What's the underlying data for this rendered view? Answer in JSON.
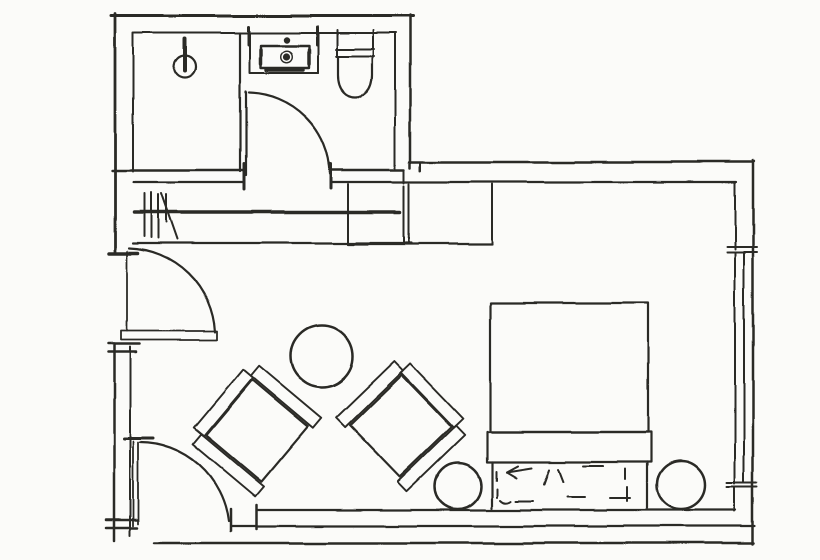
{
  "canvas": {
    "width": 820,
    "height": 560,
    "background": "#fbfbf9",
    "ink": "#2b2a26"
  },
  "floorplan": {
    "description": "hand-drawn floor plan sketch of a hotel room with bathroom, closet, seating area and bed",
    "elements": [
      {
        "name": "top-wall-outer",
        "d": "M111,16 H413",
        "w": 3
      },
      {
        "name": "top-wall-inner",
        "d": "M134,33 H396",
        "w": 2
      },
      {
        "name": "left-wall-upper-outer",
        "d": "M115,14 V252",
        "w": 2.8
      },
      {
        "name": "bathroom-left-wall-inner",
        "d": "M133,33 V171",
        "w": 2
      },
      {
        "name": "left-wall-door-jamb-tick",
        "d": "M109,253 H138",
        "w": 3.5
      },
      {
        "name": "left-wall-lower-outer",
        "d": "M114,344 V541",
        "w": 2.5
      },
      {
        "name": "left-wall-lower-inner",
        "d": "M130,347 V536",
        "w": 2
      },
      {
        "name": "left-wall-cap-ticks",
        "d": "M108,344 H140 M108,352 H136 M106,520 H137 M106,528 H137",
        "w": 2.5
      },
      {
        "name": "bathroom-right-wall-outer",
        "d": "M410,15 V168",
        "w": 2.5
      },
      {
        "name": "bathroom-right-wall-inner",
        "d": "M395,33 V170",
        "w": 2
      },
      {
        "name": "bathroom-south-wall-outer",
        "d": "M112,170 H244 M331,170 H404",
        "w": 2.4
      },
      {
        "name": "main-inner-wall-line",
        "d": "M133,182 H244 M331,182 H736",
        "w": 2.2
      },
      {
        "name": "wall-junction-ticks",
        "d": "M404,170 V183 M420,162 V171",
        "w": 2
      },
      {
        "name": "bedroom-top-wall-outer",
        "d": "M409,162 H754",
        "w": 2.4
      },
      {
        "name": "bathroom-door-jamb-ticks",
        "d": "M244,163 V189 M331,164 V188",
        "w": 3
      },
      {
        "name": "right-wall-outer",
        "d": "M753,161 V544",
        "w": 2.5
      },
      {
        "name": "right-wall-inner-upper",
        "d": "M735,182 V249",
        "w": 2
      },
      {
        "name": "window-head-ticks",
        "d": "M727,247 H757 M727,252 H757",
        "w": 2
      },
      {
        "name": "window-inner-edge",
        "d": "M735,252 V484",
        "w": 2
      },
      {
        "name": "window-glass-line",
        "d": "M744,253 V483",
        "w": 2
      },
      {
        "name": "window-sill-ticks",
        "d": "M727,483 H757 M727,487 H757",
        "w": 2
      },
      {
        "name": "right-wall-inner-lower",
        "d": "M735,487 V511",
        "w": 2
      },
      {
        "name": "bottom-wall-inner",
        "d": "M257,510 H736",
        "w": 2.2
      },
      {
        "name": "bottom-wall-inner-end-tick",
        "d": "M257,505 V529",
        "w": 2.5
      },
      {
        "name": "bottom-wall-middle",
        "d": "M232,526 H755",
        "w": 2.2
      },
      {
        "name": "bottom-wall-outer",
        "d": "M154,543 H754",
        "w": 2.5
      },
      {
        "name": "hall-door-leaf",
        "d": "M121,331 H217 V340 H121 Z",
        "w": 1.8
      },
      {
        "name": "hall-door-opening-line",
        "d": "M127,251 V331",
        "w": 1.8
      },
      {
        "name": "hall-door-swing-arc",
        "d": "M215,332 A89,89 0 0 0 129,248",
        "w": 2.2
      },
      {
        "name": "entry-door-leaf",
        "d": "M133,441 V526 M138,442 V524",
        "w": 1.8
      },
      {
        "name": "entry-door-tip-tick",
        "d": "M124,438 H153",
        "w": 3
      },
      {
        "name": "entry-door-swing-arc",
        "d": "M140,442 A90,90 0 0 1 229,521",
        "w": 2.2
      },
      {
        "name": "entry-door-jamb-tick",
        "d": "M231,509 V531",
        "w": 2.5
      },
      {
        "name": "bathroom-door-leaf",
        "d": "M246,92 V175",
        "w": 2.2
      },
      {
        "name": "bathroom-door-swing-arc",
        "d": "M249,93 A83,83 0 0 1 330,174",
        "w": 2.2
      },
      {
        "name": "shower-partition-wall",
        "d": "M240,33 V171",
        "w": 2.2
      },
      {
        "name": "shower-head-stem",
        "d": "M185,39 V71",
        "w": 4
      },
      {
        "name": "shower-head-circle",
        "type": "circle",
        "cx": 185,
        "cy": 67,
        "r": 11,
        "w": 2.2
      },
      {
        "name": "sink-counter",
        "d": "M250,33 V73 H318 V33",
        "w": 2
      },
      {
        "name": "sink-basin",
        "d": "M261,46 H309 V68 H261 Z",
        "w": 2.4
      },
      {
        "name": "sink-basin-shade-marks",
        "d": "M261,50 V64 M309,50 V64 M267,70 H303",
        "w": 3.5
      },
      {
        "name": "sink-side-ticks",
        "d": "M249,27 V45 M317,27 V45",
        "w": 3
      },
      {
        "name": "sink-faucet-dot",
        "type": "circle",
        "cx": 287,
        "cy": 40,
        "r": 3.2,
        "fill": true,
        "w": 0
      },
      {
        "name": "sink-drain-dot",
        "type": "circle",
        "cx": 287,
        "cy": 57,
        "r": 3.6,
        "fill": true,
        "w": 0
      },
      {
        "name": "sink-drain-ring",
        "type": "circle",
        "cx": 287,
        "cy": 57,
        "r": 5.8,
        "w": 1.4
      },
      {
        "name": "toilet-tank",
        "d": "M337,30 V55 M373,30 V55 M336,49 H374 M336,56 H374",
        "w": 2
      },
      {
        "name": "toilet-bowl",
        "d": "M338,56 V75 C338,91 347,97 355,97 C363,97 372,91 372,75 V56",
        "w": 2.2
      },
      {
        "name": "closet-rod",
        "d": "M134,212 H400",
        "w": 3.5
      },
      {
        "name": "closet-hanger-marks",
        "d": "M144,193 V236 M151,192 V237 M158,194 V238 M166,194 V222 M161,193 L177,239",
        "w": 2
      },
      {
        "name": "closet-bottom-edge",
        "d": "M133,243 H412",
        "w": 2.2
      },
      {
        "name": "closet-right-edge",
        "d": "M404,186 V243",
        "w": 2
      },
      {
        "name": "console-left-edge",
        "d": "M348,184 V244",
        "w": 2
      },
      {
        "name": "console-bottom-edge",
        "d": "M348,244 H492",
        "w": 2.2
      },
      {
        "name": "console-divider",
        "d": "M409,184 V244",
        "w": 2
      },
      {
        "name": "console-right-edge",
        "d": "M492,184 V244",
        "w": 2
      },
      {
        "name": "bed-mattress",
        "d": "M490,303 H648 V432 H490 Z",
        "w": 2.2
      },
      {
        "name": "bed-foot-band",
        "d": "M487,432 H651 V462 H487 Z",
        "w": 2.2
      },
      {
        "name": "bed-headboard-sides",
        "d": "M492,462 V508 M647,462 V508",
        "w": 2.2
      },
      {
        "name": "bed-pillow-sketch-marks",
        "d": "M531,468 L506,472 M506,472 L517,466 M506,472 L516,478 M549,470 L544,484 M558,469 L563,482 M583,466 H603 M625,469 V479 M627,487 V501 M496,471 V480 M497,489 V497 M500,500 Q505,505 511,501 M516,501 H533 M567,497 H584 M610,498 H630",
        "w": 2
      },
      {
        "name": "nightstand-left",
        "type": "circle",
        "cx": 458,
        "cy": 486,
        "r": 23,
        "w": 2.5
      },
      {
        "name": "nightstand-right",
        "type": "circle",
        "cx": 681,
        "cy": 485,
        "r": 24,
        "w": 2.5
      },
      {
        "name": "lounge-table",
        "type": "circle",
        "cx": 322,
        "cy": 356,
        "r": 31,
        "w": 2.5
      }
    ],
    "chairs": [
      {
        "name": "armchair-left",
        "cx": 257,
        "cy": 431,
        "rotation": 40
      },
      {
        "name": "armchair-right",
        "cx": 401,
        "cy": 426,
        "rotation": 136
      }
    ],
    "chair_template": {
      "paths": [
        {
          "name": "seat",
          "d": "M-36,-36 H36 V36 H-36 Z",
          "w": 2.2
        },
        {
          "name": "back-rail",
          "d": "M-50,-38 H-37 V38 H-50 Z",
          "w": 1.9
        },
        {
          "name": "arm-rail-top",
          "d": "M-40,-51 H41 V-38 H-40 Z",
          "w": 1.9
        },
        {
          "name": "arm-rail-bottom",
          "d": "M-40,38 H41 V51 H-40 Z",
          "w": 1.9
        }
      ]
    }
  }
}
